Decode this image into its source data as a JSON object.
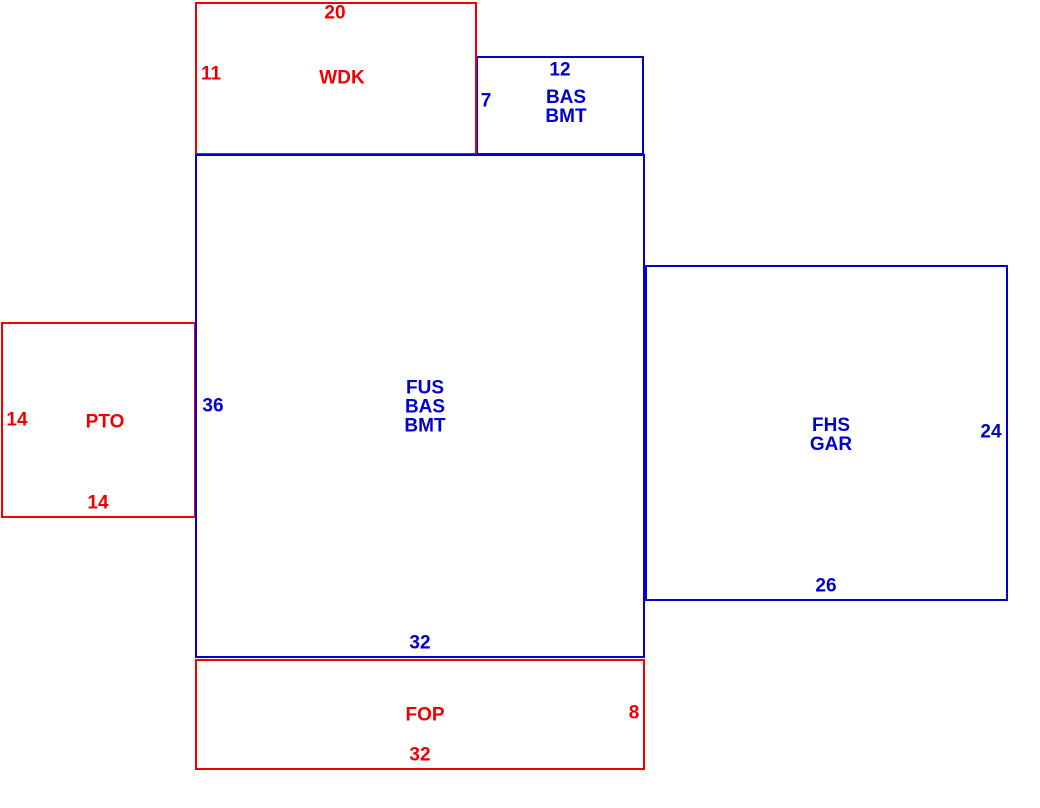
{
  "title": "floorplan-sketch",
  "colors": {
    "red": "#EE0000",
    "blue": "#0000CC",
    "background": "#FFFFFF"
  },
  "rooms": [
    {
      "id": "bas-bmt-upper",
      "name": "BAS BMT",
      "color": "blue",
      "x": 476,
      "y": 56,
      "w": 168,
      "h": 99,
      "label_lines": [
        "BAS",
        "BMT"
      ],
      "label_x": 566,
      "label_y": 107
    },
    {
      "id": "wdk",
      "name": "WDK",
      "color": "red",
      "x": 195,
      "y": 2,
      "w": 282,
      "h": 153,
      "label_lines": [
        "WDK"
      ],
      "label_x": 342,
      "label_y": 78
    },
    {
      "id": "pto",
      "name": "PTO",
      "color": "red",
      "x": 1,
      "y": 322,
      "w": 195,
      "h": 196,
      "label_lines": [
        "PTO"
      ],
      "label_x": 105,
      "label_y": 422
    },
    {
      "id": "fop",
      "name": "FOP",
      "color": "red",
      "x": 195,
      "y": 659,
      "w": 450,
      "h": 111,
      "label_lines": [
        "FOP"
      ],
      "label_x": 425,
      "label_y": 715
    },
    {
      "id": "fhs-gar",
      "name": "FHS GAR",
      "color": "blue",
      "x": 645,
      "y": 265,
      "w": 363,
      "h": 336,
      "label_lines": [
        "FHS",
        "GAR"
      ],
      "label_x": 831,
      "label_y": 435
    },
    {
      "id": "fus-bas-bmt",
      "name": "FUS BAS BMT",
      "color": "blue",
      "x": 195,
      "y": 154,
      "w": 450,
      "h": 504,
      "label_lines": [
        "FUS",
        "BAS",
        "BMT"
      ],
      "label_x": 425,
      "label_y": 407
    }
  ],
  "dimensions": [
    {
      "text": "20",
      "color": "red",
      "room": "wdk",
      "side": "top",
      "x": 335,
      "y": 13
    },
    {
      "text": "11",
      "color": "red",
      "room": "wdk",
      "side": "left",
      "x": 211,
      "y": 74
    },
    {
      "text": "12",
      "color": "blue",
      "room": "bas-bmt-upper",
      "side": "top",
      "x": 560,
      "y": 70
    },
    {
      "text": "7",
      "color": "blue",
      "room": "bas-bmt-upper",
      "side": "left",
      "x": 486,
      "y": 101
    },
    {
      "text": "36",
      "color": "blue",
      "room": "fus-bas-bmt",
      "side": "left",
      "x": 213,
      "y": 406
    },
    {
      "text": "32",
      "color": "blue",
      "room": "fus-bas-bmt",
      "side": "bottom",
      "x": 420,
      "y": 643
    },
    {
      "text": "14",
      "color": "red",
      "room": "pto",
      "side": "left",
      "x": 17,
      "y": 420
    },
    {
      "text": "14",
      "color": "red",
      "room": "pto",
      "side": "bottom",
      "x": 98,
      "y": 503
    },
    {
      "text": "24",
      "color": "blue",
      "room": "fhs-gar",
      "side": "right",
      "x": 991,
      "y": 432
    },
    {
      "text": "26",
      "color": "blue",
      "room": "fhs-gar",
      "side": "bottom",
      "x": 826,
      "y": 586
    },
    {
      "text": "8",
      "color": "red",
      "room": "fop",
      "side": "right",
      "x": 634,
      "y": 713
    },
    {
      "text": "32",
      "color": "red",
      "room": "fop",
      "side": "bottom",
      "x": 420,
      "y": 755
    }
  ]
}
